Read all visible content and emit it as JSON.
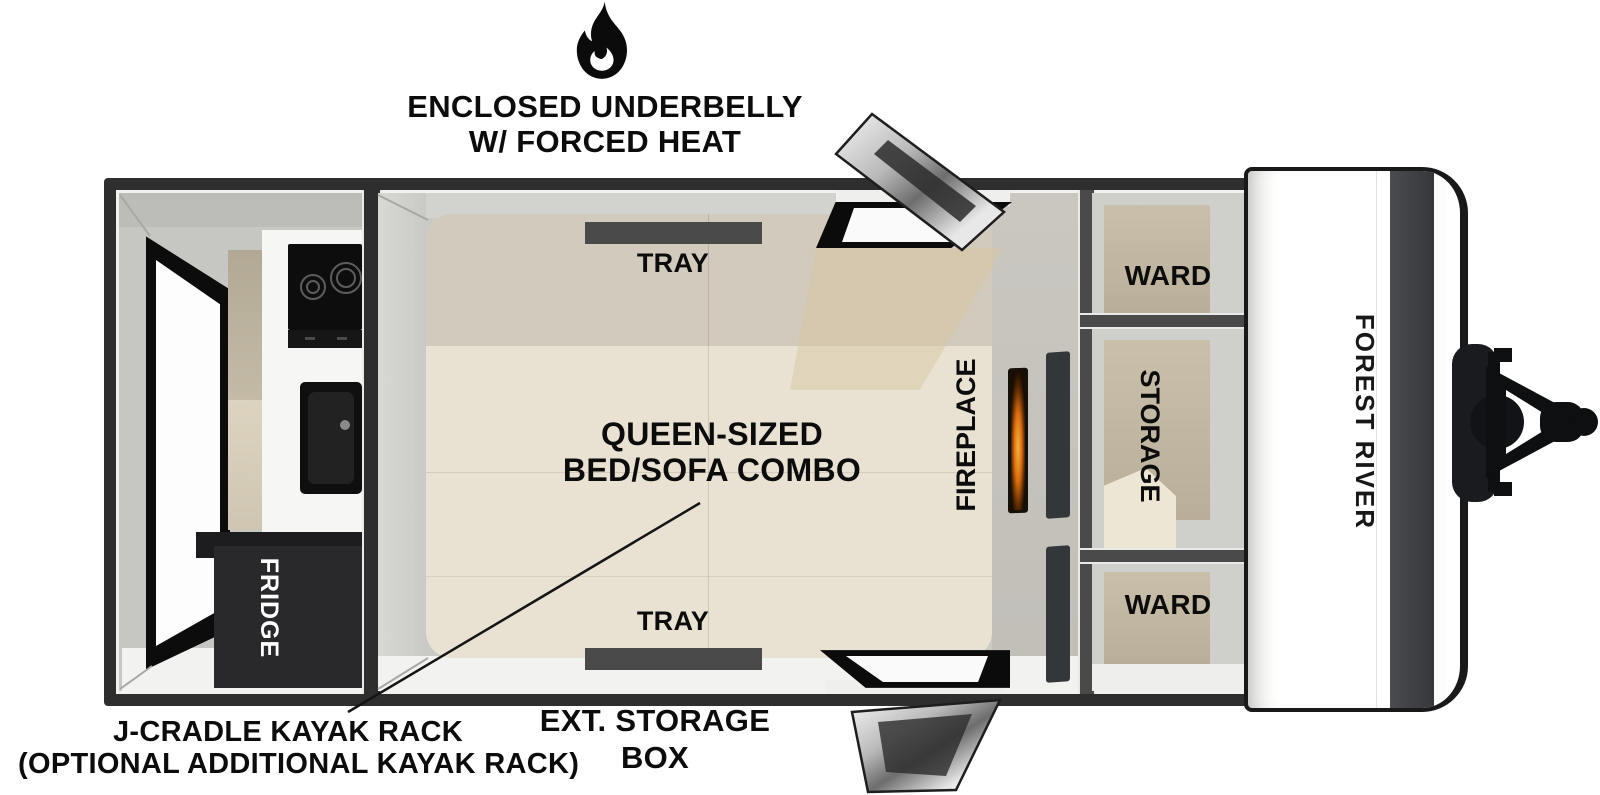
{
  "annotations": {
    "underbelly": {
      "icon": "flame-icon",
      "line1": "ENCLOSED UNDERBELLY",
      "line2": "W/ FORCED HEAT"
    },
    "kayak_rack": {
      "line1": "J-CRADLE KAYAK RACK",
      "line2": "(OPTIONAL ADDITIONAL KAYAK RACK)"
    },
    "ext_storage_box": {
      "line1": "EXT. STORAGE",
      "line2": "BOX"
    }
  },
  "trailer": {
    "brand": "FOREST RIVER",
    "labels": {
      "fridge": "FRIDGE",
      "tray_top": "TRAY",
      "tray_bottom": "TRAY",
      "bed_line1": "QUEEN-SIZED",
      "bed_line2": "BED/SOFA COMBO",
      "fireplace": "FIREPLACE",
      "ward_top": "WARD",
      "storage": "STORAGE",
      "ward_bottom": "WARD"
    }
  },
  "colors": {
    "frame": "#2e2e2e",
    "wall": "#cbcbc7",
    "floor": "#f2f2f0",
    "bed": "#e9e2d3",
    "bed_header": "#d2cabd",
    "tray": "#4a4a4a",
    "cabinet_tan": "#c7bda9",
    "appliance_black": "#101010",
    "fridge": "#29292b",
    "cap_stripe": "#3e4043",
    "flame_accent": "#d96d12",
    "text": "#0c0c0c"
  }
}
